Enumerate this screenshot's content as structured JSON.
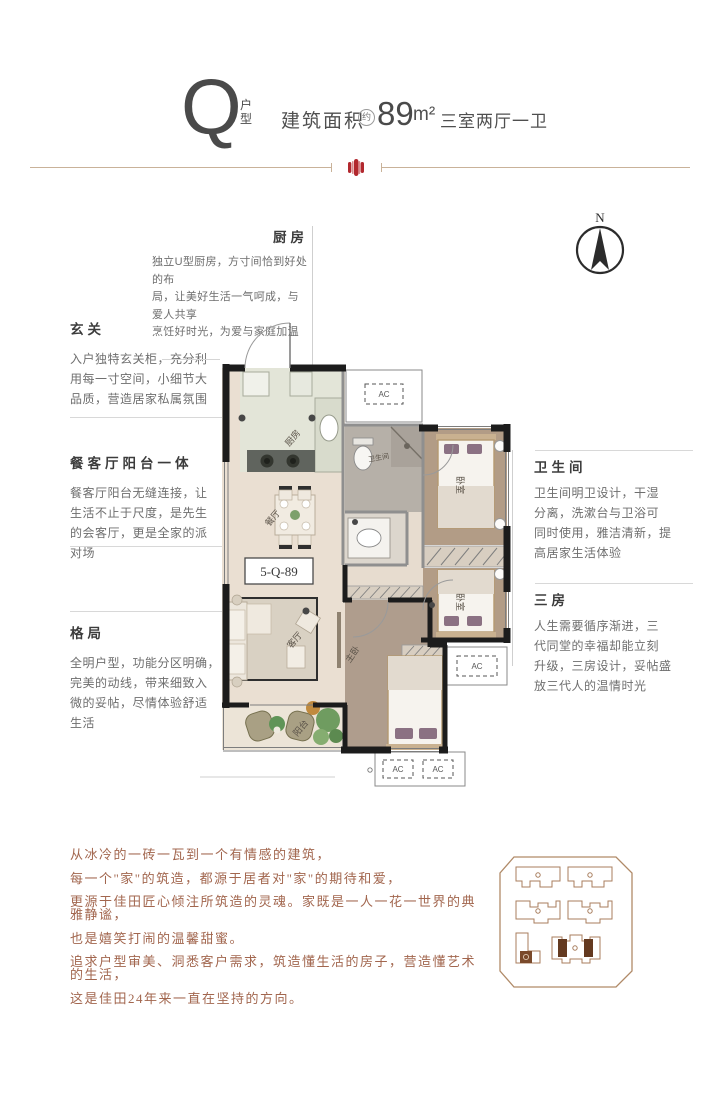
{
  "header": {
    "letter": "Q",
    "type_top": "户",
    "type_bottom": "型",
    "area_label": "建筑面积",
    "approx": "约",
    "area_value": "89",
    "area_unit": "m²",
    "rooms_summary": "三室两厅一卫"
  },
  "compass": {
    "north": "N"
  },
  "annotations": {
    "kitchen": {
      "title": "厨房",
      "text": "独立U型厨房，方寸间恰到好处的布\n局，让美好生活一气呵成，与爱人共享\n烹饪好时光，为爱与家庭加温"
    },
    "entry": {
      "title": "玄关",
      "text": "入户独特玄关柜，充分利\n用每一寸空间，小细节大\n品质，营造居家私属氛围"
    },
    "dining_living": {
      "title": "餐客厅阳台一体",
      "text": "餐客厅阳台无缝连接，让\n生活不止于尺度，是先生\n的会客厅，更是全家的派\n对场"
    },
    "layout": {
      "title": "格局",
      "text": "全明户型，功能分区明确，\n完美的动线，带来细致入\n微的妥帖，尽情体验舒适\n生活"
    },
    "bathroom": {
      "title": "卫生间",
      "text": "卫生间明卫设计，干湿\n分离，洗漱台与卫浴可\n同时使用，雅洁清新，提\n高居家生活体验"
    },
    "three_rooms": {
      "title": "三房",
      "text": "人生需要循序渐进，三\n代同堂的幸福却能立刻\n升级，三房设计，妥帖盛\n放三代人的温情时光"
    }
  },
  "plan": {
    "unit_code": "5-Q-89",
    "rooms": {
      "kitchen": "厨房",
      "dining": "餐厅",
      "living": "客厅",
      "balcony": "阳台",
      "master": "主卧",
      "bedroom": "卧室",
      "bathroom": "卫生间",
      "ac": "AC"
    }
  },
  "manifesto": {
    "lines": [
      "从冰冷的一砖一瓦到一个有情感的建筑，",
      "每一个\"家\"的筑造，都源于居者对\"家\"的期待和爱，",
      "更源于佳田匠心倾注所筑造的灵魂。家既是一人一花一世界的典雅静谧，",
      "也是嬉笑打闹的温馨甜蜜。",
      "追求户型审美、洞悉客户需求，筑造懂生活的房子，营造懂艺术的生活，",
      "这是佳田24年来一直在坚持的方向。"
    ]
  },
  "colors": {
    "accent_red": "#b2282e",
    "divider_tan": "#c9b299",
    "manifesto_brown": "#a2664e",
    "wall_black": "#1c1c1c",
    "site_plan_outline": "#a87e5e"
  }
}
